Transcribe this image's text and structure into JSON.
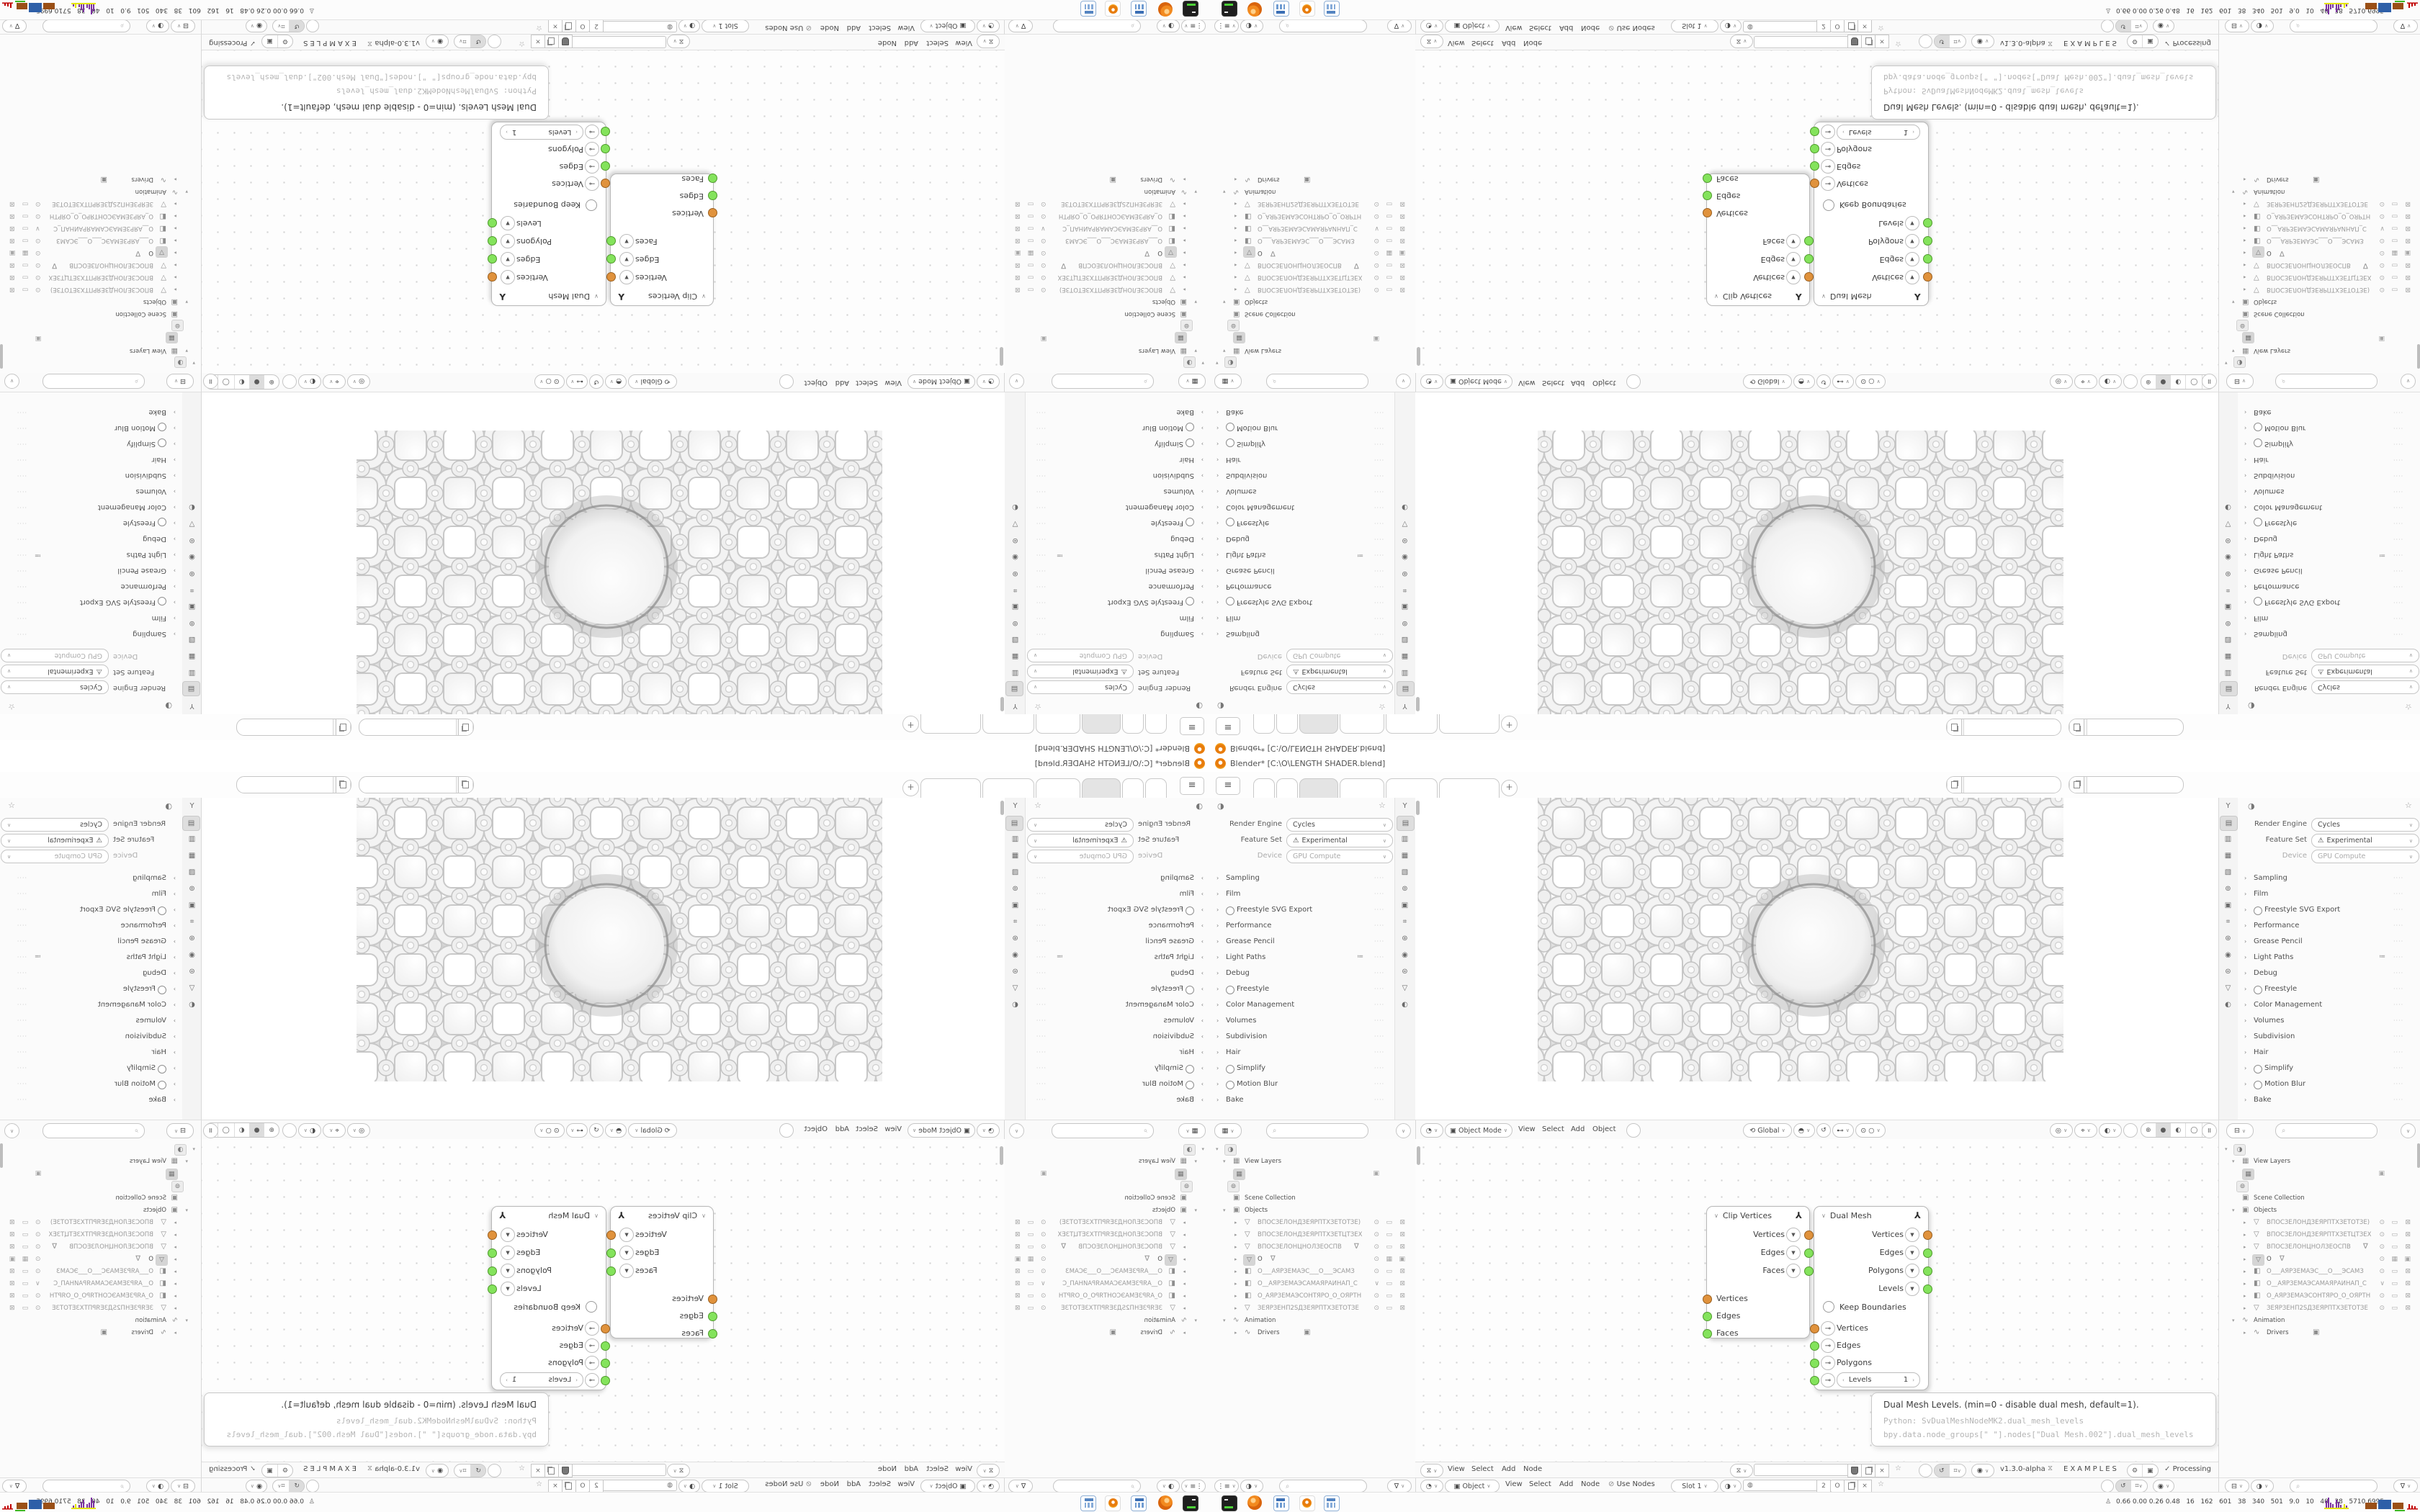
{
  "window": {
    "title": "Blender* [C:\\O\\LENGTH SHADER.blend]"
  },
  "properties": {
    "render_engine_label": "Render Engine",
    "render_engine_value": "Cycles",
    "feature_set_label": "Feature Set",
    "feature_set_value": "Experimental",
    "device_label": "Device",
    "device_value": "GPU Compute",
    "sections": [
      {
        "label": "Sampling"
      },
      {
        "label": "Film"
      },
      {
        "label": "Freestyle SVG Export",
        "radio": true
      },
      {
        "label": "Performance"
      },
      {
        "label": "Grease Pencil"
      },
      {
        "label": "Light Paths",
        "extra": true
      },
      {
        "label": "Debug"
      },
      {
        "label": "Freestyle",
        "radio": true
      },
      {
        "label": "Color Management"
      },
      {
        "label": "Volumes"
      },
      {
        "label": "Subdivision"
      },
      {
        "label": "Hair"
      },
      {
        "label": "Simplify",
        "radio": true
      },
      {
        "label": "Motion Blur",
        "radio": true
      },
      {
        "label": "Bake"
      }
    ]
  },
  "prop_tabs": [
    "tool",
    "render",
    "output",
    "view-layer",
    "scene",
    "world",
    "object",
    "modifiers",
    "particles",
    "physics",
    "constraints",
    "object-data",
    "material"
  ],
  "outliner": {
    "view_layers_label": "View Layers",
    "scene_collection_label": "Scene Collection",
    "objects_label": "Objects",
    "animation_label": "Animation",
    "drivers_label": "Drivers",
    "items": [
      {
        "icon": "mesh",
        "name": "ВПОСЗЕЛОНДЗЕЯРПТХЗЕТОТЗЕ)",
        "right": "eye"
      },
      {
        "icon": "mesh",
        "name": "ВПОСЗЕЛОНДЗЕЯРПТХЗЕТЦТЗЕХ",
        "right": "eye"
      },
      {
        "icon": "mesh",
        "name": "ВПОСЗЕЛОНЦНОЛЗЕОСПВ",
        "funnel": true,
        "right": "eye"
      },
      {
        "icon": "mesh",
        "name": "O",
        "selected": true,
        "funnel": true,
        "right": "eye"
      },
      {
        "icon": "camera",
        "name": "О___АЯРЗЕМАЭС___О___ЭСАМЗ",
        "right": "eye"
      },
      {
        "icon": "camera",
        "name": "О__АЯРЗЕМАЭСАМАЯРАИНАП_С",
        "right": "chev"
      },
      {
        "icon": "camera",
        "name": "О_АЯРЗЕМАЭСОНТЯРО_О_ОЯРТН",
        "right": "eye"
      },
      {
        "icon": "mesh",
        "name": "ЗЕЯРЗЕНП2SДЗЕЯРПТХЗЕТОТЗЕ",
        "right": "eye"
      }
    ]
  },
  "viewport_header": {
    "mode": "Object Mode",
    "menu_view": "View",
    "menu_select": "Select",
    "menu_add": "Add",
    "menu_object": "Object",
    "orientation": "Global"
  },
  "node_editor": {
    "clip_node": {
      "title": "Clip Vertices",
      "outputs": [
        {
          "label": "Vertices",
          "color": "#E0923C"
        },
        {
          "label": "Edges",
          "color": "#84E35C"
        },
        {
          "label": "Faces",
          "color": "#84E35C"
        }
      ],
      "inputs": [
        {
          "label": "Vertices",
          "color": "#E0923C"
        },
        {
          "label": "Edges",
          "color": "#84E35C"
        },
        {
          "label": "Faces",
          "color": "#84E35C"
        }
      ]
    },
    "dual_node": {
      "title": "Dual Mesh",
      "outputs": [
        {
          "label": "Vertices",
          "color": "#E0923C"
        },
        {
          "label": "Edges",
          "color": "#84E35C"
        },
        {
          "label": "Polygons",
          "color": "#84E35C"
        },
        {
          "label": "Levels",
          "color": "#84E35C"
        }
      ],
      "keep_boundaries_label": "Keep Boundaries",
      "inputs": [
        {
          "label": "Vertices",
          "color": "#E0923C"
        },
        {
          "label": "Edges",
          "color": "#84E35C"
        },
        {
          "label": "Polygons",
          "color": "#84E35C"
        },
        {
          "label": "Levels",
          "color": "#84E35C",
          "value": "1"
        }
      ]
    },
    "tooltip": {
      "title": "Dual Mesh Levels. (min=0 - disable dual mesh, default=1).",
      "python_line": "Python: SvDualMeshNodeMK2.dual_mesh_levels",
      "bpy_line": "bpy.data.node_groups[\" \"].nodes[\"Dual Mesh.002\"].dual_mesh_levels"
    }
  },
  "ne_header1": {
    "menu_view": "View",
    "menu_select": "Select",
    "menu_add": "Add",
    "menu_node": "Node",
    "version": "v1.3.0-alpha",
    "examples_label": "EXAMPLES",
    "processing_label": "Processing"
  },
  "ne_header2": {
    "object_label": "Object",
    "menu_view": "View",
    "menu_select": "Select",
    "menu_add": "Add",
    "menu_node": "Node",
    "use_nodes_label": "Use Nodes",
    "slot_label": "Slot 1",
    "count_value": "2",
    "o_value": "O"
  },
  "taskbar": {
    "stats": "0.66 0.00 0.26 0.48   16   162   601   38   340   501   9.0   10   40   38   5710 6995",
    "apps": [
      "terminal",
      "firefox",
      "calculator",
      "blender",
      "calculator-2"
    ]
  },
  "colors": {
    "accent_orange": "#E87D0D",
    "socket_orange": "#E0923C",
    "socket_green": "#84E35C",
    "graph_purple": "#7A2FA0",
    "graph_yellow": "#E3E300",
    "graph_blue": "#2E5FA8",
    "graph_brown": "#9A4F16",
    "graph_green": "#3CB520",
    "graph_red": "#C00000"
  }
}
